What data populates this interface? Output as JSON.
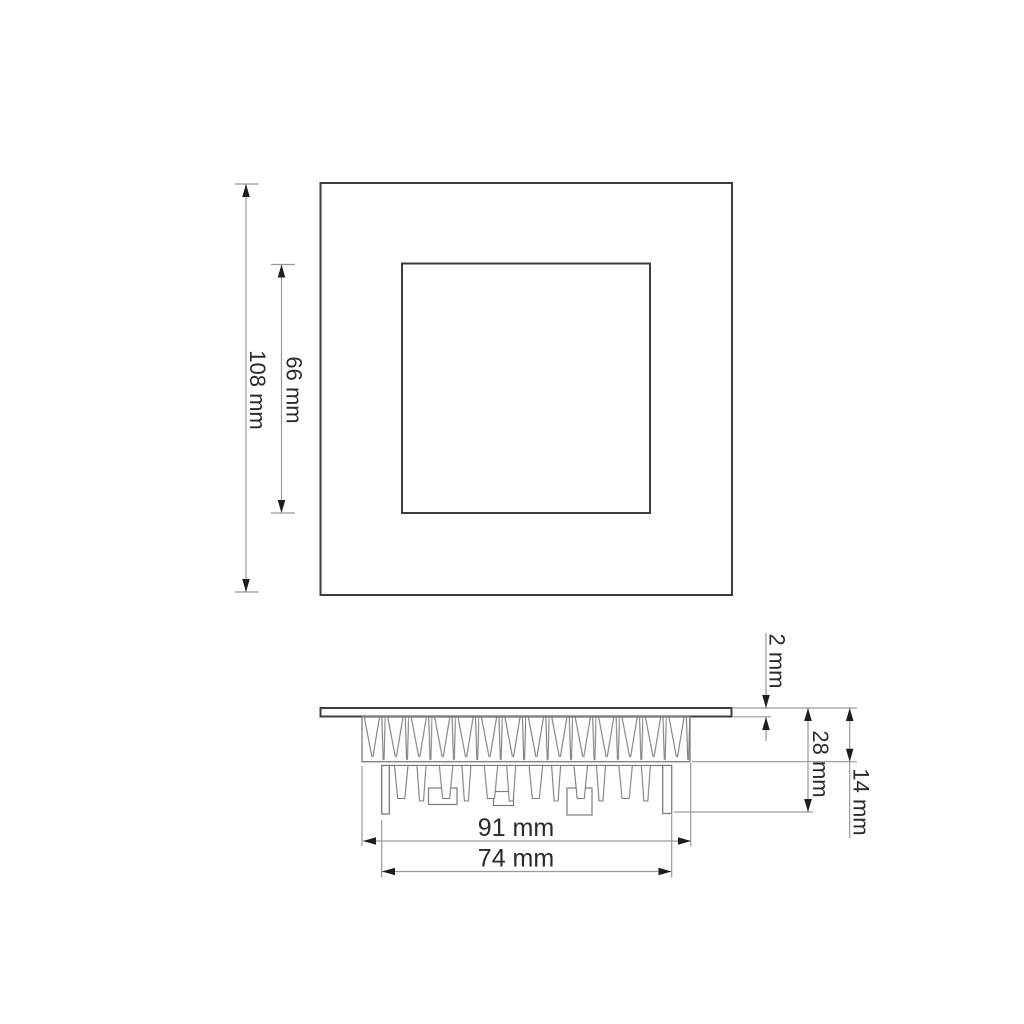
{
  "drawing": {
    "type": "technical-dimension-drawing",
    "subject": "square-recessed-led-panel-light",
    "colors": {
      "background": "#ffffff",
      "object_outline": "#3c3c3c",
      "detail_line": "#7d7d7d",
      "dimension_line": "#9a9a9a",
      "arrow": "#1e1e1e",
      "text": "#2a2a2a"
    },
    "top_view": {
      "outer_size_label": "108 mm",
      "inner_size_label": "66 mm"
    },
    "side_view": {
      "panel_thickness_label": "2 mm",
      "overall_depth_label": "28 mm",
      "recess_depth_label": "14 mm",
      "heatsink_width_label": "91 mm",
      "body_width_label": "74 mm"
    }
  }
}
